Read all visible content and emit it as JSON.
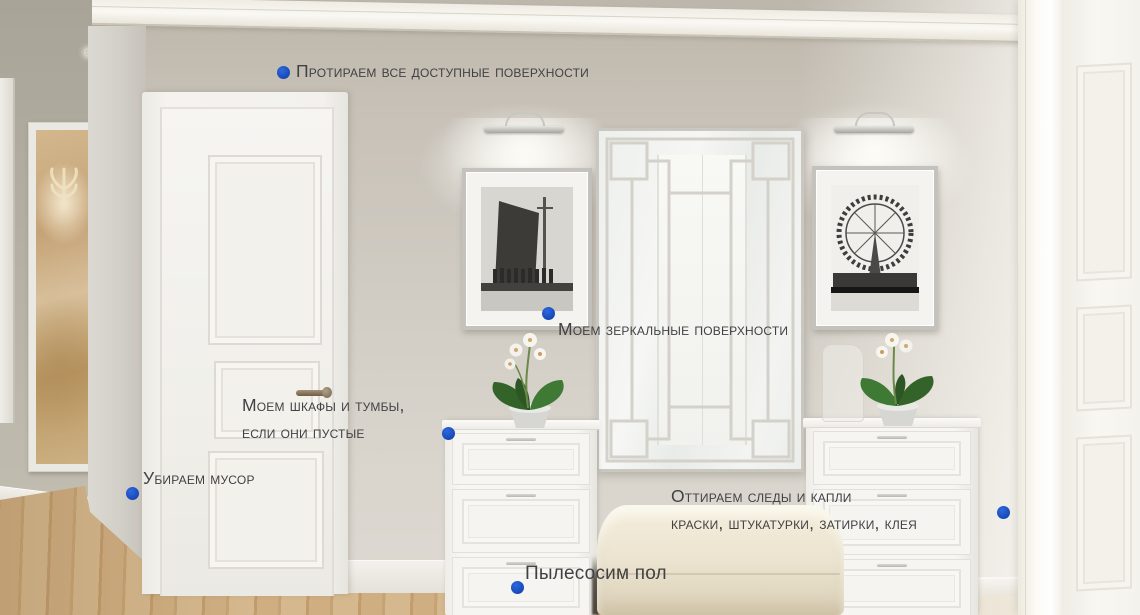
{
  "scene": {
    "description": "Светлая прихожая: белая дверь, зеркальное панно, два постера с подсветкой, белые комоды с орхидеями, банкетка",
    "objects": [
      "white-paneled-door",
      "mirror-panel",
      "framed-poster-building",
      "framed-poster-ferris-wheel",
      "picture-lights",
      "white-chest-of-drawers-left",
      "white-chest-of-drawers-right",
      "orchid-plants",
      "cream-bench",
      "gold-art-panel",
      "wood-floor",
      "right-white-door"
    ],
    "palette": {
      "wall": "#cac4ba",
      "hall_wall": "#b3aea2",
      "wood_floor": "#cbab80",
      "bench": "#ece4d0",
      "gold_panel": "#c5a377",
      "white_trim": "#f4f3ef"
    }
  },
  "annotations": {
    "dot_color": "#1d53c6",
    "text_color": "#414144",
    "items": [
      {
        "id": "wipe-surfaces",
        "lines": [
          "Протираем все доступные поверхности"
        ]
      },
      {
        "id": "clean-mirrors",
        "lines": [
          "Моем зеркальные поверхности"
        ]
      },
      {
        "id": "clean-cabinets",
        "lines": [
          "Моем шкафы и тумбы,",
          "если они пустые"
        ]
      },
      {
        "id": "remove-trash",
        "lines": [
          "Убираем мусор"
        ]
      },
      {
        "id": "remove-stains",
        "lines": [
          "Оттираем следы и капли",
          "краски, штукатурки, затирки, клея"
        ]
      },
      {
        "id": "vacuum-floor",
        "lines": [
          "Пылесосим пол"
        ]
      }
    ]
  }
}
